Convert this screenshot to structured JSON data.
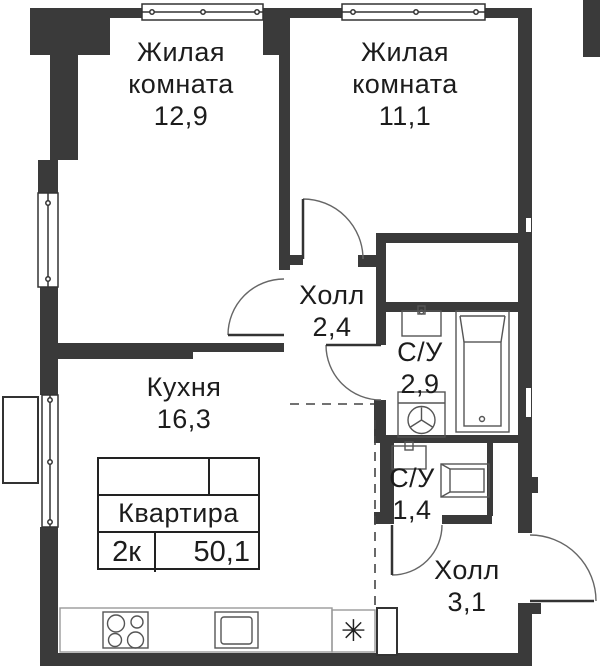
{
  "rooms": {
    "living1": {
      "name": "Жилая\nкомната",
      "area": "12,9"
    },
    "living2": {
      "name": "Жилая\nкомната",
      "area": "11,1"
    },
    "hall_upper": {
      "name": "Холл",
      "area": "2,4"
    },
    "bathroom_large": {
      "name": "С/У",
      "area": "2,9"
    },
    "kitchen": {
      "name": "Кухня",
      "area": "16,3"
    },
    "bathroom_small": {
      "name": "С/У",
      "area": "1,4"
    },
    "hall_lower": {
      "name": "Холл",
      "area": "3,1"
    }
  },
  "stamp": {
    "title": "Квартира",
    "type": "2к",
    "total_area": "50,1"
  },
  "symbols": {
    "washer_place": "✳"
  },
  "colors": {
    "wall": "#3a3a3a",
    "line": "#555555",
    "text": "#1c1c1c"
  }
}
